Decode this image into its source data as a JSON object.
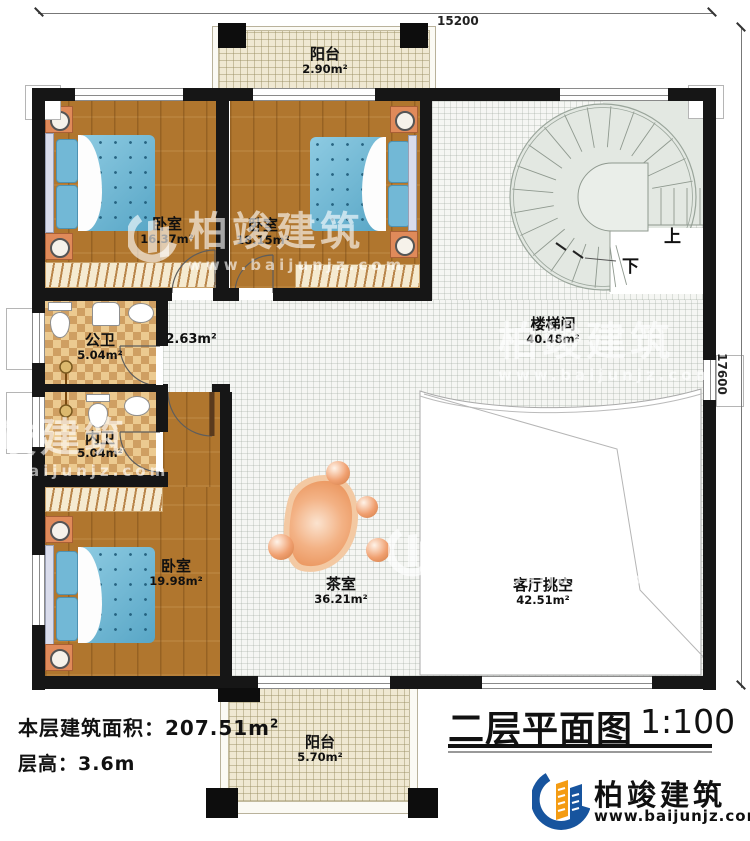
{
  "dimensions": {
    "top": "15200",
    "right": "17600"
  },
  "rooms": {
    "balcony_top": {
      "name": "阳台",
      "area": "2.90m²"
    },
    "bedroom1": {
      "name": "卧室",
      "area": "16.37m²"
    },
    "bedroom2": {
      "name": "卧室",
      "area": "18.15m²"
    },
    "stairwell": {
      "name": "楼梯间",
      "area": "40.48m²",
      "up": "上",
      "down": "下"
    },
    "bath_public": {
      "name": "公卫",
      "area": "5.04m²"
    },
    "corridor": {
      "area": "2.63m²"
    },
    "bath_private": {
      "name": "内卫",
      "area": "5.04m²"
    },
    "bedroom3": {
      "name": "卧室",
      "area": "19.98m²"
    },
    "tea_room": {
      "name": "茶室",
      "area": "36.21m²"
    },
    "living_void": {
      "name": "客厅挑空",
      "area": "42.51m²"
    },
    "balcony_bottom": {
      "name": "阳台",
      "area": "5.70m²"
    }
  },
  "notes": {
    "area_label": "本层建筑面积：",
    "area_value": "207.51m",
    "area_sup": "2",
    "floor_height": "层高：3.6m"
  },
  "title_block": {
    "title": "二层平面图",
    "scale": "1:100"
  },
  "brand": {
    "name": "柏竣建筑",
    "url": "www.baijunjz.com"
  },
  "watermark": {
    "text": "柏竣建筑",
    "url": "www.baijunjz.com"
  },
  "colors": {
    "wall": "#161616",
    "wood": "#b0762e",
    "checker": "#cf9f62",
    "balcony": "#efe8d2",
    "stair": "#e3e8e2",
    "accent": "#e8925c",
    "logo_blue": "#17549e",
    "logo_orange": "#f49c13"
  }
}
